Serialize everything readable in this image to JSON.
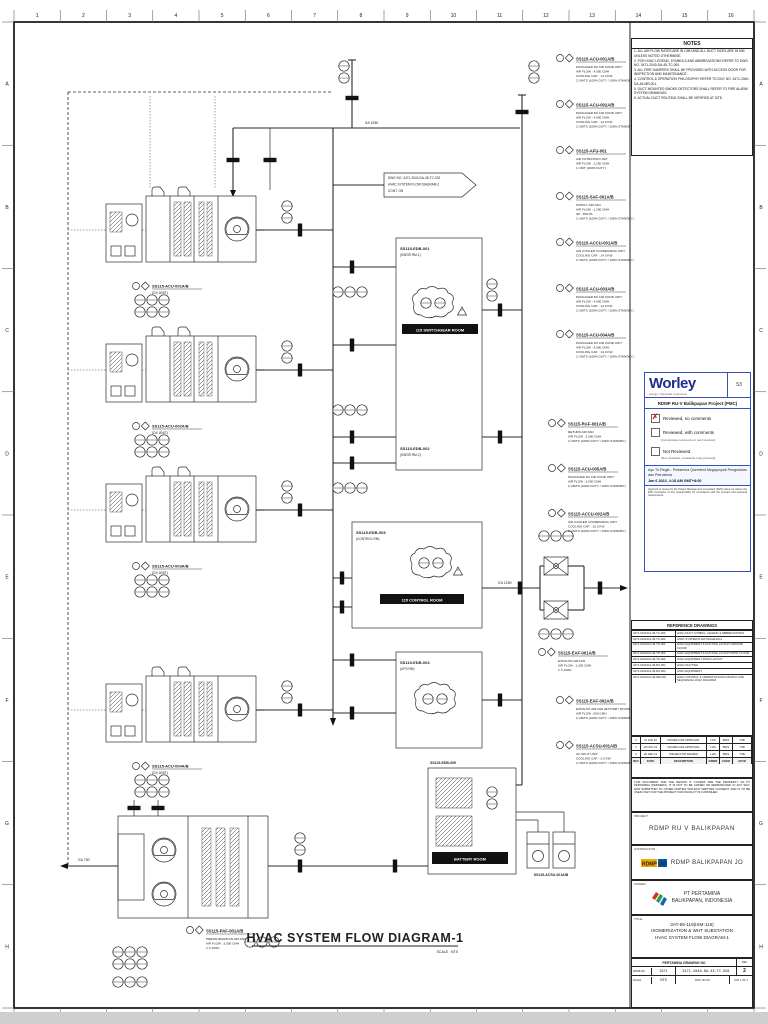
{
  "frame": {
    "columns": [
      "1",
      "2",
      "3",
      "4",
      "5",
      "6",
      "7",
      "8",
      "9",
      "10",
      "11",
      "12",
      "13",
      "14",
      "15",
      "16"
    ],
    "side_letters": [
      "A",
      "B",
      "C",
      "D",
      "E",
      "F",
      "G",
      "H"
    ]
  },
  "drawing_title": {
    "text": "HVAC SYSTEM FLOW DIAGRAM-1",
    "subtitle": "SCALE : NTS"
  },
  "notes": {
    "title": "NOTES",
    "items": [
      "1. ALL AIR FLOW RATES ARE IN CMH AND ALL DUCT SIZES ARE IN MM UNLESS NOTED OTHERWISE.",
      "2. FOR HVAC LEGEND, SYMBOLS AND ABBREVIATIONS REFER TO DWG NO. 3471-2040-DA-45-TC-000.",
      "3. ALL FIRE DAMPERS SHALL BE PROVIDED WITH ACCESS DOOR FOR INSPECTION AND MAINTENANCE.",
      "4. CONTROL & OPERATION PHILOSOPHY REFER TO DOC NO. 3471-2040-DA-45-MR-001.",
      "5. DUCT MOUNTED SMOKE DETECTORS SHALL REFER TO FIRE ALARM SYSTEM DRAWINGS.",
      "6. ACTUAL DUCT ROUTING SHALL BE VERIFIED AT SITE."
    ]
  },
  "stamp": {
    "logo": "Worley",
    "tagline": "energy | chemicals | resources",
    "code": "53",
    "project": "RDMP RU-V Balikpapan Project (PMC)",
    "checkmark": "✗",
    "options": [
      {
        "label": "Reviewed, no comments",
        "note": ""
      },
      {
        "label": "Reviewed, with comments",
        "note": "(Incorporate comments in next revision)"
      },
      {
        "label": "Not Reviewed",
        "note": "(Not reviewed, contractor may proceed)"
      }
    ],
    "signer": "Ayu Tri Regla - Pertamina Querident Megaproyek Pengolahan dan Petrokimia",
    "date": "Jan 6 2022, 4:18 AM GMT+8:00",
    "fineprint": "Approval or review by the Project Management Consultant (PMC) does not relieve the EPC Contractor of any responsibility for compliance with the contract and technical requirements."
  },
  "reference_drawings": {
    "title": "REFERENCE DRAWINGS",
    "rows": [
      [
        "3471-2040-DA-45-TC-000",
        "HVAC DUCT SYMBOL, LEGEND & ABBREVIATIONS"
      ],
      [
        "3471-2040-DA-45-TC-002",
        "HVAC SYSTEM FLOW DIAGRAM-2"
      ],
      [
        "3471-2040-DA-45-TD-001",
        "HVAC EQUIPMENT & DUCTING LAYOUT GROUND FLOOR"
      ],
      [
        "3471-2040-DA-45-TD-002",
        "HVAC EQUIPMENT & DUCTING LAYOUT FIRST FLOOR"
      ],
      [
        "3471-2040-DA-45-TD-003",
        "HVAC EQUIPMENT ROOF LAYOUT"
      ],
      [
        "3471-2040-DA-45-DS-001",
        "HVAC DUCTING"
      ],
      [
        "3471-2040-DA-45-DS-002",
        "HVAC EQUIPMENT"
      ],
      [
        "3471-2040-DA-45-MR-001",
        "HVAC CONTROL & OPERATION PHILOSOPHY AND SEQUENCE LOGIC DIAGRAM"
      ]
    ]
  },
  "revisions": {
    "rows": [
      [
        "2",
        "11 JAN 22",
        "ISSUED FOR APPROVAL",
        "LHS",
        "BWS",
        "YSB"
      ],
      [
        "1",
        "15 NOV 21",
        "ISSUED FOR APPROVAL",
        "LHS",
        "BWS",
        "YSB"
      ],
      [
        "0",
        "20 SEP 21",
        "ISSUED FOR REVIEW",
        "LHS",
        "BWS",
        "YSB"
      ],
      [
        "REV",
        "DATE",
        "DESCRIPTION",
        "DRWN",
        "CHKD",
        "APVD"
      ]
    ],
    "disclaimer": "THIS DOCUMENT AND THE DESIGN IT COVERS ARE THE PROPERTY OF PT PERTAMINA (PERSERO). IT IS NOT TO BE COPIED OR REPRODUCED IN ANY WAY, NOR SUBMITTED TO OTHER PARTIES WITHOUT WRITTEN CONSENT, AND IS TO BE USED ONLY FOR THE PROJECT FOR WHICH IT IS FURNISHED."
  },
  "title_block": {
    "project_label": "PROJECT :",
    "project": "RDMP RU V BALIKPAPAN",
    "contractor_label": "CONTRACTOR :",
    "contractor": "RDMP BALIKPAPAN JO",
    "contractor_logo_text": "RDMP",
    "contractor_logo_sub": "JO",
    "owner_label": "OWNER :",
    "owner_line1": "PT PERTAMINA",
    "owner_line2": "BALIKPAPAN, INDONESIA",
    "title_label": "TITLE :",
    "title_lines": [
      "3AT-55-115(ISM-115)",
      "ISOMERIZATION & WHT SUBSTATION",
      "HVAC SYSTEM FLOW DIAGRAM-1"
    ],
    "drawing": {
      "band": "PERTAMINA DRAWING NO",
      "rev_label": "REV",
      "wpb_label": "WP&B NO",
      "wpb": "3471",
      "number": "3471-2040-DA-45-TC-001",
      "rev": "2",
      "scale_label": "SCALE",
      "scale": "NTS",
      "docid_label": "DOC ID NO",
      "sheet": "SHT 1 OF 1"
    }
  },
  "diagram": {
    "delta": "2",
    "supply_label": "SA 1250",
    "exhaust_left_label": "EA 750",
    "room_exhaust_label": "EA 1250",
    "flag_lines": [
      "DWG NO. 3471-2040-DA-45-TC-002",
      "HVAC SYSTEM FLOW DIAGRAM-2",
      "CONT. ON"
    ],
    "units": {
      "acu1": {
        "tag": "SS115-ACU-001A/B",
        "sub": "(DX UNIT)"
      },
      "acu2": {
        "tag": "SS115-ACU-002A/B",
        "sub": "(DX UNIT)"
      },
      "acu3": {
        "tag": "SS115-ACU-003A/B",
        "sub": "(DX UNIT)"
      },
      "acu4": {
        "tag": "SS115-ACU-004A/B",
        "sub": "(DX UNIT)"
      },
      "acsu": {
        "tag": "SS115-ACSU-001A/B"
      }
    },
    "rooms": {
      "r1": {
        "tag": "SS115-EDB-001",
        "sub": "(SWGR RM-1)",
        "label": "115 SWITCHGEAR ROOM",
        "tag2": "SS115-EDB-002",
        "sub2": "(SWGR RM-2)"
      },
      "r2": {
        "tag": "SS115-EDB-003",
        "sub": "(CONTROL RM)",
        "label": "115 CONTROL ROOM"
      },
      "r3": {
        "tag": "SS115-EDB-004",
        "sub": "(UPS RM)"
      },
      "r4": {
        "tag": "SS115-EDB-005",
        "label": "BATTERY ROOM"
      }
    },
    "callouts": [
      {
        "tag": "SS115-ACU-001A/B",
        "lines": [
          "PACKAGED DX AIR COND UNIT",
          "AIR FLOW : 4,500 CMH",
          "COOLING CAP. : 14.0 KW",
          "2 UNITS (100% DUTY / 100% STANDBY)"
        ]
      },
      {
        "tag": "SS115-ACU-002A/B",
        "lines": [
          "PACKAGED DX AIR COND UNIT",
          "AIR FLOW : 4,500 CMH",
          "COOLING CAP. : 14.0 KW",
          "2 UNITS (100% DUTY / 100% STANDBY)"
        ]
      },
      {
        "tag": "SS115-AFU-001",
        "lines": [
          "AIR FILTRATION UNIT",
          "AIR FLOW : 1,250 CMH",
          "1 UNIT (100% DUTY)"
        ]
      },
      {
        "tag": "SS115-SAF-001A/B",
        "lines": [
          "SUPPLY AIR FAN",
          "AIR FLOW : 1,250 CMH",
          "SP : 350 PA",
          "2 UNITS (100% DUTY / 100% STANDBY)"
        ]
      },
      {
        "tag": "SS115-ACCU-001A/B",
        "lines": [
          "AIR COOLED CONDENSING UNIT",
          "COOLING CAP. : 14.0 KW",
          "2 UNITS (100% DUTY / 100% STANDBY)"
        ]
      },
      {
        "tag": "SS115-ACU-003A/B",
        "lines": [
          "PACKAGED DX AIR COND UNIT",
          "AIR FLOW : 4,500 CMH",
          "COOLING CAP. : 14.0 KW",
          "2 UNITS (100% DUTY / 100% STANDBY)"
        ]
      },
      {
        "tag": "SS115-ACU-004A/B",
        "lines": [
          "PACKAGED DX AIR COND UNIT",
          "AIR FLOW : 4,500 CMH",
          "COOLING CAP. : 14.0 KW",
          "2 UNITS (100% DUTY / 100% STANDBY)"
        ]
      },
      {
        "tag": "SS115-RAF-001A/B",
        "lines": [
          "RETURN AIR FAN",
          "AIR FLOW : 2,500 CMH",
          "2 UNITS (100% DUTY / 100% STANDBY)"
        ]
      },
      {
        "tag": "SS115-ACU-005A/B",
        "lines": [
          "PACKAGED DX AIR COND UNIT",
          "AIR FLOW : 3,000 CMH",
          "2 UNITS (100% DUTY / 100% STANDBY)"
        ]
      },
      {
        "tag": "SS115-ACCU-002A/B",
        "lines": [
          "AIR COOLED CONDENSING UNIT",
          "COOLING CAP. : 10.5 KW",
          "2 UNITS (100% DUTY / 100% STANDBY)"
        ]
      },
      {
        "tag": "SS115-EAF-001A/B",
        "lines": [
          "EXHAUST AIR FAN",
          "AIR FLOW : 1,250 CMH",
          "2 X 100%"
        ]
      },
      {
        "tag": "SS115-EAF-002A/B",
        "lines": [
          "EXHAUST AIR FAN (BATTERY ROOM)",
          "AIR FLOW : 900 CMH",
          "2 UNITS (100% DUTY / 100% STANDBY)"
        ]
      },
      {
        "tag": "SS115-ACSU-001A/B",
        "lines": [
          "AC SPLIT UNIT",
          "COOLING CAP. : 3.5 KW",
          "2 UNITS (100% DUTY / 100% STANDBY)"
        ]
      },
      {
        "tag": "SS115-PAF-001A/B",
        "lines": [
          "PRESSURIZATION AIR FAN",
          "AIR FLOW : 3,500 CMH",
          "2 X 100%"
        ]
      }
    ]
  }
}
